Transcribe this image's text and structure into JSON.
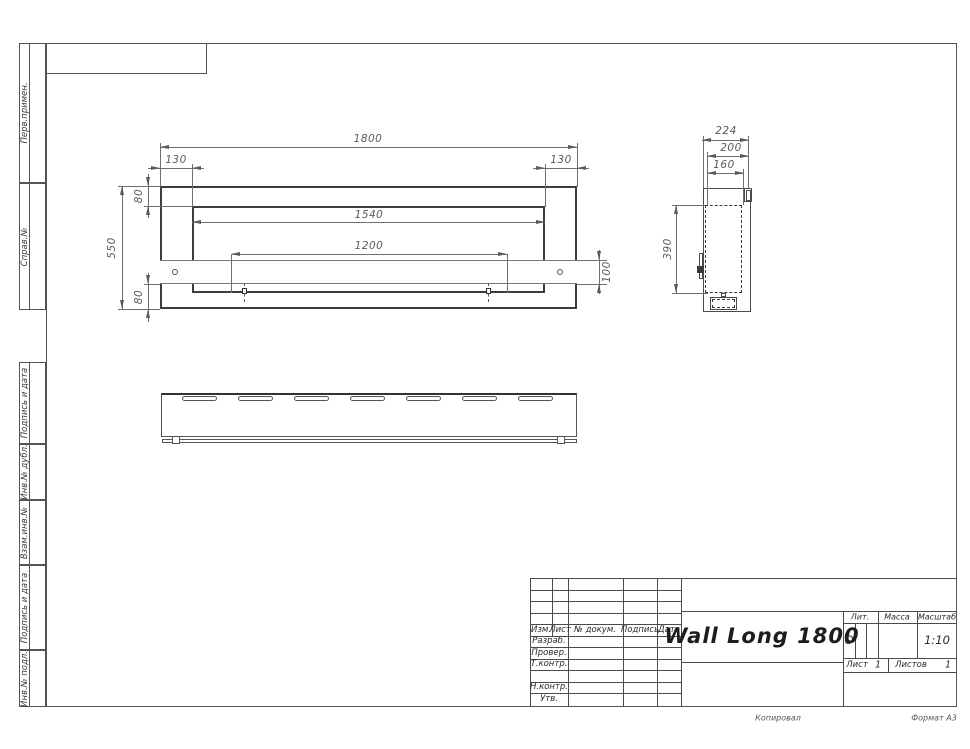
{
  "sheet": {
    "copied_note": "Копировал",
    "format_note": "Формат А3"
  },
  "margin": {
    "labels": [
      "Перв.примен.",
      "Справ.№",
      "Подпись и дата",
      "Инв.№ дубл.",
      "Взам.инв.№",
      "Подпись и дата",
      "Инв.№ подл."
    ]
  },
  "front_view": {
    "overall_width": "1800",
    "left_offset": "130",
    "right_offset": "130",
    "top_inset": "80",
    "opening_width": "1540",
    "overall_height": "550",
    "mount_span": "1200",
    "bracket_height": "100",
    "bottom_inset": "80"
  },
  "side_view": {
    "overall_depth": "224",
    "depth_200": "200",
    "depth_160": "160",
    "inner_height": "390"
  },
  "title_block": {
    "title": "Wall Long 1800",
    "col_izm": "Изм.",
    "col_list": "Лист",
    "col_doc": "№ докум.",
    "col_sign": "Подпись",
    "col_date": "Дата",
    "row_razrab": "Разраб.",
    "row_prover": "Провер.",
    "row_tkontr": "Т.контр.",
    "row_nkontr": "Н.контр.",
    "row_utv": "Утв.",
    "lit_label": "Лит.",
    "mass_label": "Масса",
    "scale_label": "Масштаб",
    "lit_value": "О",
    "scale_value": "1:10",
    "sheet_label": "Лист",
    "sheet_value": "1",
    "sheets_label": "Листов",
    "sheets_value": "1"
  }
}
